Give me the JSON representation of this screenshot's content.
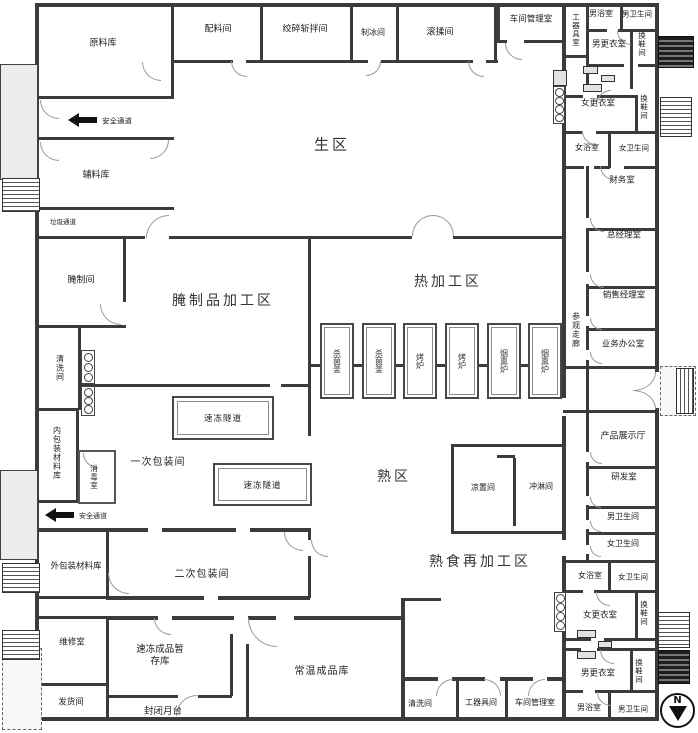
{
  "colors": {
    "wall": "#3b3b3b",
    "wall_light": "#9a9a9a",
    "text": "#222222",
    "platform_fill": "#ececec",
    "background": "#ffffff"
  },
  "zones": {
    "raw_area": "生区",
    "cured_processing_area": "腌制品加工区",
    "hot_processing_area": "热加工区",
    "cooked_area": "熟区",
    "cooked_reprocessing_area": "熟食再加工区"
  },
  "rooms": {
    "raw_material_store": "原料库",
    "ingredient_room": "配料间",
    "grinding_chopping_room": "绞碎斩拌间",
    "ice_making_room": "制冰间",
    "tumbling_room": "滚揉间",
    "workshop_office": "车间管理室",
    "tool_store": "工器具室",
    "tool_room": "工器具间",
    "mens_bathroom": "男浴室",
    "mens_toilet": "男卫生间",
    "mens_changing_room": "男更衣室",
    "womens_bathroom": "女浴室",
    "womens_toilet": "女卫生间",
    "womens_changing_room": "女更衣室",
    "shoe_changing_room": "换鞋间",
    "finance_office": "财务室",
    "general_manager_office": "总经理室",
    "sales_manager_office": "销售经理室",
    "business_office": "业务办公室",
    "visitor_corridor": "参观走廊",
    "product_showroom": "产品展示厅",
    "rnd_room": "研发室",
    "auxiliary_material_store": "辅料库",
    "curing_room": "腌制间",
    "washing_room": "清洗间",
    "inner_packaging_material_store": "内包装材料库",
    "disinfection_room": "消毒室",
    "primary_packaging_room": "一次包装间",
    "cooling_room": "凉置间",
    "shower_room": "冲淋间",
    "outer_packaging_material_store": "外包装材料库",
    "secondary_packaging_room": "二次包装间",
    "maintenance_room": "维修室",
    "frozen_product_buffer_store": "速冻成品暂存库",
    "dispatch_room": "发货间",
    "enclosed_dock": "封闭月台",
    "ambient_product_store": "常温成品库"
  },
  "equipment": {
    "sterilizer": "杀菌釜",
    "oven": "烤炉",
    "smoker": "烟熏炉",
    "freezing_tunnel": "速冻隧道"
  },
  "annotations": {
    "safety_passage": "安全通道",
    "garbage_passage": "垃圾通道",
    "compass_north": "N"
  }
}
